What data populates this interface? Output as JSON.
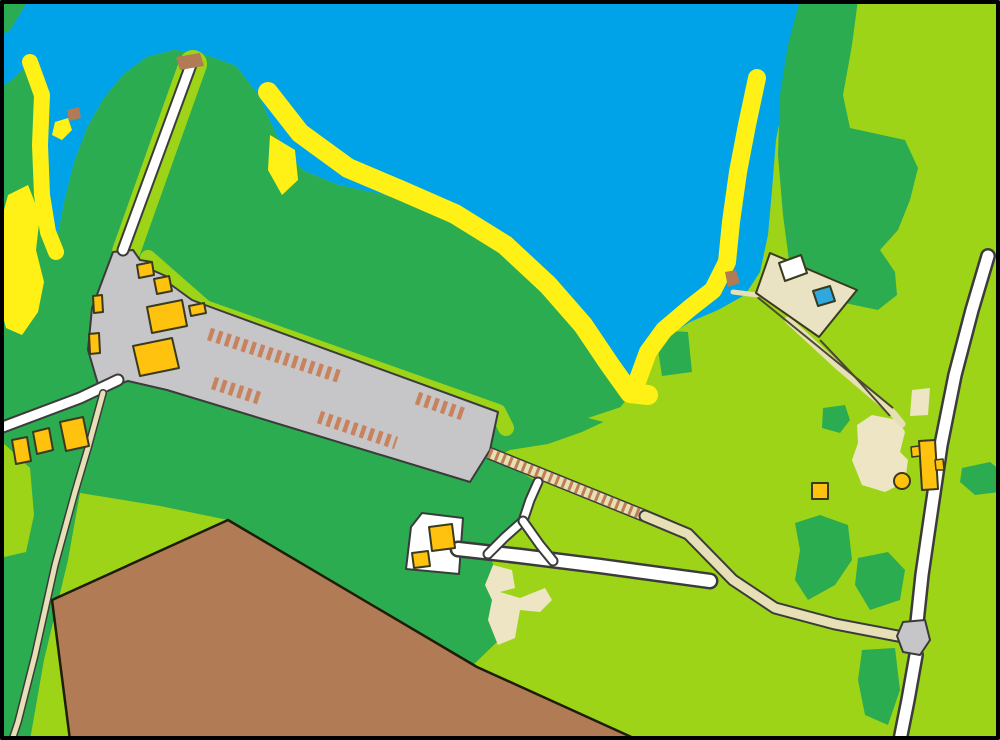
{
  "canvas": {
    "width": 1000,
    "height": 740
  },
  "palette": {
    "water": "#00A2E8",
    "forest": "#2CAC50",
    "open": "#9ED417",
    "beach": "#FFF115",
    "field": "#B07B55",
    "field_border": "#1F1C07",
    "paved": "#C6C5C7",
    "casing": "#3B3B3B",
    "road_white": "#FFFFFF",
    "path_beige": "#E7E0B6",
    "rung": "#BE7F52",
    "sand": "#EDE5C3",
    "compound": "#E9E2C3",
    "building": "#FFC20E",
    "building_outline": "#3A3A1E",
    "car": "#C9825E",
    "pool": "#2FA8E0",
    "pier": "#B07B55",
    "fence": "#4A4A32",
    "frame": "#000000"
  },
  "map": {
    "features": [
      {
        "name": "lake-water",
        "kind": "polygon",
        "fill": "water",
        "pts": "28,0 822,0 800,50 785,95 776,140 772,190 768,235 760,272 745,295 718,310 690,322 662,340 645,358 634,390 618,368 590,330 558,293 520,258 478,228 432,208 385,195 338,185 302,170 278,138 258,95 236,66 206,55 174,50 147,57 124,74 104,98 87,128 74,163 64,203 57,240 50,250 43,238 39,195 39,145 42,105 37,75 25,68 12,80 0,88 0,36 10,30"
      },
      {
        "name": "forest-top-left-corner",
        "kind": "polygon",
        "fill": "forest",
        "pts": "0,0 28,0 10,30 0,36"
      },
      {
        "name": "forest-main-west",
        "kind": "polygon",
        "fill": "forest",
        "pts": "0,88 12,80 25,68 37,75 42,105 39,145 39,195 43,238 50,250 57,240 64,203 74,163 87,128 104,98 124,74 147,57 174,50 206,55 236,66 258,95 278,138 302,170 338,185 385,195 432,208 478,228 520,258 558,293 590,330 618,368 634,390 626,400 612,418 582,432 548,444 510,450 494,458 538,482 526,520 490,556 497,575 499,640 468,670 373,604 228,520 160,506 80,493 68,560 44,660 30,740 0,740"
      },
      {
        "name": "forest-northeast-band",
        "kind": "polygon",
        "fill": "forest",
        "pts": "800,0 858,0 852,45 843,95 850,128 905,140 918,168 910,200 898,230 880,250 895,272 897,295 878,310 840,302 810,288 790,268 783,215 778,155 780,95 788,45"
      },
      {
        "name": "bush-east-1",
        "kind": "polygon",
        "fill": "forest",
        "pts": "823,408 845,405 850,420 840,433 822,428"
      },
      {
        "name": "bush-east-2",
        "kind": "polygon",
        "fill": "forest",
        "pts": "795,523 820,515 848,525 852,560 835,585 808,600 795,580 800,550"
      },
      {
        "name": "bush-east-3",
        "kind": "polygon",
        "fill": "forest",
        "pts": "858,558 888,552 905,570 900,600 870,610 855,585"
      },
      {
        "name": "bush-east-4",
        "kind": "polygon",
        "fill": "forest",
        "pts": "862,650 895,648 900,690 888,725 865,715 858,680"
      },
      {
        "name": "bush-east-5",
        "kind": "polygon",
        "fill": "forest",
        "pts": "962,468 990,462 1000,470 1000,492 975,495 960,482"
      },
      {
        "name": "bush-bay-notch",
        "kind": "polygon",
        "fill": "forest",
        "pts": "655,330 688,332 692,372 662,376"
      },
      {
        "name": "road-verge-pier",
        "kind": "stroke",
        "stroke": "open",
        "w": 28,
        "pts": "193,64 158,162 126,252"
      },
      {
        "name": "clearing-left-edge",
        "kind": "polygon",
        "fill": "open",
        "pts": "0,440 30,468 34,515 26,552 0,558"
      },
      {
        "name": "clearing-triangle",
        "kind": "polygon",
        "fill": "open",
        "pts": "80,493 215,521 108,580"
      },
      {
        "name": "verge-parking-edge",
        "kind": "stroke",
        "stroke": "open",
        "w": 16,
        "pts": "148,258 205,308 498,412 506,428"
      },
      {
        "name": "clearing-bay-south",
        "kind": "polygon",
        "fill": "open",
        "pts": "588,418 648,398 715,420 655,435"
      },
      {
        "name": "beach-west",
        "kind": "stroke",
        "stroke": "beach",
        "w": 20,
        "pts": "268,92 300,133 348,168 400,190 455,214 505,245 548,285 583,325 610,365 630,393 648,395"
      },
      {
        "name": "beach-east",
        "kind": "stroke",
        "stroke": "beach",
        "w": 18,
        "pts": "757,78 747,125 738,172 731,222 727,262 713,290 690,308 664,330 648,352 637,382"
      },
      {
        "name": "beach-inlet",
        "kind": "stroke",
        "stroke": "beach",
        "w": 16,
        "pts": "30,62 42,95 40,145 42,195 48,232 56,252"
      },
      {
        "name": "beach-left-blob",
        "kind": "polygon",
        "fill": "beach",
        "pts": "8,195 28,185 40,215 36,250 44,282 38,312 22,335 6,328 0,305 0,225"
      },
      {
        "name": "beach-hook",
        "kind": "polygon",
        "fill": "beach",
        "pts": "55,122 68,118 72,130 62,140 52,135"
      },
      {
        "name": "beach-headland-patch",
        "kind": "polygon",
        "fill": "beach",
        "pts": "270,135 295,150 298,180 282,195 268,170"
      },
      {
        "name": "plowed-field",
        "kind": "polygon",
        "fill": "field",
        "stroke": "field_border",
        "sw": 2.5,
        "pts": "70,740 52,600 228,520 477,667 638,740"
      },
      {
        "name": "sand-patch-south",
        "kind": "polygon",
        "fill": "sand",
        "pts": "493,565 512,570 515,588 500,592 520,598 545,588 552,600 540,612 520,610 515,638 498,645 488,620 492,600 485,585"
      },
      {
        "name": "sand-patch-east",
        "kind": "polygon",
        "fill": "sand",
        "pts": "857,425 872,415 898,420 905,432 900,452 908,460 905,482 885,492 862,485 852,460 858,443"
      },
      {
        "name": "sand-patch-east-small",
        "kind": "polygon",
        "fill": "sand",
        "pts": "912,390 930,388 928,415 910,416"
      },
      {
        "name": "parking-lot",
        "kind": "polygon",
        "fill": "paved",
        "stroke": "casing",
        "sw": 2,
        "pts": "113,252 133,250 140,260 152,262 152,270 168,277 170,284 192,300 205,305 498,412 490,450 470,482 167,390 128,381 100,391 88,350 92,308"
      },
      {
        "name": "stairs-path-casing",
        "kind": "stroke",
        "stroke": "casing",
        "w": 13,
        "cap": "butt",
        "pts": "489,453 645,516"
      },
      {
        "name": "stairs-path-bed",
        "kind": "stroke",
        "stroke": "path_beige",
        "w": 10,
        "cap": "butt",
        "pts": "489,453 645,516"
      },
      {
        "name": "stairs-path-rungs",
        "kind": "stroke",
        "stroke": "rung",
        "w": 10,
        "cap": "butt",
        "dash": "3,4.2",
        "pts": "489,453 645,516"
      },
      {
        "name": "road-pier",
        "kind": "road",
        "pts": "192,62 123,250",
        "casing_w": 13,
        "fill_w": 9
      },
      {
        "name": "road-west-curve",
        "kind": "road",
        "pts": "0,428 40,413 80,398 118,380",
        "casing_w": 13,
        "fill_w": 9
      },
      {
        "name": "path-southwest",
        "kind": "road",
        "pts": "103,393 88,448 75,492 55,565 35,655 18,722 12,740",
        "casing_w": 8,
        "fill_w": 5,
        "fill": "path_beige"
      },
      {
        "name": "yard-pad",
        "kind": "polygon",
        "fill": "road_white",
        "stroke": "casing",
        "sw": 2,
        "pts": "422,513 463,518 459,574 406,569 411,527"
      },
      {
        "name": "road-south-main",
        "kind": "road",
        "pts": "458,549 520,556 600,566 710,581",
        "casing_w": 17,
        "fill_w": 12
      },
      {
        "name": "path-branch-west",
        "kind": "road",
        "pts": "488,554 505,537 523,521",
        "casing_w": 11,
        "fill_w": 7
      },
      {
        "name": "path-branch-north",
        "kind": "road",
        "pts": "523,521 530,500 538,482",
        "casing_w": 11,
        "fill_w": 7
      },
      {
        "name": "path-branch-east",
        "kind": "road",
        "pts": "523,521 540,545 553,561",
        "casing_w": 11,
        "fill_w": 7
      },
      {
        "name": "path-main-beige",
        "kind": "road",
        "pts": "645,516 688,534 733,580 775,608 835,624 903,637",
        "casing_w": 13,
        "fill_w": 9,
        "fill": "path_beige"
      },
      {
        "name": "road-east-upper",
        "kind": "road",
        "pts": "988,256 972,310 955,375 941,445 930,520 922,575 917,622",
        "casing_w": 16,
        "fill_w": 11
      },
      {
        "name": "road-east-lower",
        "kind": "road",
        "pts": "916,655 908,700 900,740",
        "casing_w": 16,
        "fill_w": 11
      },
      {
        "name": "junction-pad",
        "kind": "polygon",
        "fill": "paved",
        "stroke": "casing",
        "sw": 2,
        "pts": "903,622 925,620 930,640 920,655 903,652 897,636"
      },
      {
        "name": "path-compound-lane",
        "kind": "stroke",
        "stroke": "path_beige",
        "w": 7,
        "pts": "788,320 840,368 893,413 902,424"
      },
      {
        "name": "fence-lane-upper",
        "kind": "stroke",
        "stroke": "fence",
        "w": 2,
        "cap": "butt",
        "pts": "756,296 820,348 893,408"
      },
      {
        "name": "fence-lane-lower",
        "kind": "stroke",
        "stroke": "fence",
        "w": 2,
        "cap": "butt",
        "pts": "820,340 856,378 890,416"
      },
      {
        "name": "path-compound-shore",
        "kind": "stroke",
        "stroke": "path_beige",
        "w": 5,
        "pts": "733,292 757,295"
      },
      {
        "name": "compound-yard",
        "kind": "polygon",
        "fill": "compound",
        "stroke": "building_outline",
        "sw": 2,
        "pts": "770,253 857,290 819,337 756,293"
      },
      {
        "name": "building-white-house",
        "kind": "polygon",
        "fill": "road_white",
        "stroke": "building_outline",
        "sw": 2,
        "pts": "779,263 801,255 807,273 785,281"
      },
      {
        "name": "swimming-pool",
        "kind": "polygon",
        "fill": "pool",
        "stroke": "building_outline",
        "sw": 2,
        "pts": "813,291 830,286 835,301 818,306"
      },
      {
        "name": "building-a",
        "kind": "polygon",
        "fill": "building",
        "stroke": "building_outline",
        "sw": 2,
        "pts": "137,265 152,262 154,275 139,278"
      },
      {
        "name": "building-b",
        "kind": "polygon",
        "fill": "building",
        "stroke": "building_outline",
        "sw": 2,
        "pts": "154,279 169,276 172,291 157,294"
      },
      {
        "name": "building-c",
        "kind": "polygon",
        "fill": "building",
        "stroke": "building_outline",
        "sw": 2,
        "pts": "93,296 102,295 103,312 94,313"
      },
      {
        "name": "building-d-large",
        "kind": "polygon",
        "fill": "building",
        "stroke": "building_outline",
        "sw": 2,
        "pts": "147,307 182,300 187,326 152,333"
      },
      {
        "name": "building-e",
        "kind": "polygon",
        "fill": "building",
        "stroke": "building_outline",
        "sw": 2,
        "pts": "189,306 204,303 206,313 191,316"
      },
      {
        "name": "building-f",
        "kind": "polygon",
        "fill": "building",
        "stroke": "building_outline",
        "sw": 2,
        "pts": "89,334 99,333 100,353 90,354"
      },
      {
        "name": "building-g-large",
        "kind": "polygon",
        "fill": "building",
        "stroke": "building_outline",
        "sw": 2,
        "pts": "133,346 172,338 179,368 140,376"
      },
      {
        "name": "building-h",
        "kind": "polygon",
        "fill": "building",
        "stroke": "building_outline",
        "sw": 2,
        "pts": "12,440 27,437 31,461 16,464"
      },
      {
        "name": "building-i",
        "kind": "polygon",
        "fill": "building",
        "stroke": "building_outline",
        "sw": 2,
        "pts": "33,432 49,428 53,450 37,454"
      },
      {
        "name": "building-j",
        "kind": "polygon",
        "fill": "building",
        "stroke": "building_outline",
        "sw": 2,
        "pts": "60,422 83,417 89,446 66,451"
      },
      {
        "name": "building-k",
        "kind": "polygon",
        "fill": "building",
        "stroke": "building_outline",
        "sw": 2,
        "pts": "429,527 452,524 455,548 432,551"
      },
      {
        "name": "building-l",
        "kind": "polygon",
        "fill": "building",
        "stroke": "building_outline",
        "sw": 2,
        "pts": "412,553 428,551 430,566 414,568"
      },
      {
        "name": "building-m",
        "kind": "polygon",
        "fill": "building",
        "stroke": "building_outline",
        "sw": 2,
        "pts": "812,483 828,483 828,499 812,499"
      },
      {
        "name": "building-n-main",
        "kind": "polygon",
        "fill": "building",
        "stroke": "building_outline",
        "sw": 2,
        "pts": "919,441 935,440 938,489 922,490"
      },
      {
        "name": "building-n-wing-west",
        "kind": "polygon",
        "fill": "building",
        "stroke": "building_outline",
        "sw": 1.5,
        "pts": "911,447 919,446 920,456 912,457"
      },
      {
        "name": "building-n-wing-east",
        "kind": "polygon",
        "fill": "building",
        "stroke": "building_outline",
        "sw": 1.5,
        "pts": "935,460 943,459 944,470 936,470"
      },
      {
        "name": "tank-circle",
        "kind": "circle",
        "cx": 902,
        "cy": 481,
        "r": 8,
        "fill": "building",
        "stroke": "building_outline",
        "sw": 2
      },
      {
        "name": "parked-row-1",
        "kind": "stroke",
        "stroke": "car",
        "w": 13,
        "cap": "butt",
        "dash": "4.4,4.4",
        "pts": "209,334 341,377"
      },
      {
        "name": "parked-row-2",
        "kind": "stroke",
        "stroke": "car",
        "w": 13,
        "cap": "butt",
        "dash": "4.4,4.4",
        "pts": "213,383 262,399"
      },
      {
        "name": "parked-row-3",
        "kind": "stroke",
        "stroke": "car",
        "w": 13,
        "cap": "butt",
        "dash": "4.4,4.4",
        "pts": "319,417 396,443"
      },
      {
        "name": "parked-row-4",
        "kind": "stroke",
        "stroke": "car",
        "w": 13,
        "cap": "butt",
        "dash": "4.4,4.4",
        "pts": "417,398 463,414"
      },
      {
        "name": "pier-head",
        "kind": "polygon",
        "fill": "pier",
        "pts": "176,57 200,53 204,66 180,70"
      },
      {
        "name": "boat-landing",
        "kind": "polygon",
        "fill": "pier",
        "pts": "725,272 736,270 740,283 728,287"
      },
      {
        "name": "boat",
        "kind": "polygon",
        "fill": "pier",
        "pts": "67,110 79,107 81,118 69,121"
      },
      {
        "name": "map-frame",
        "kind": "polygon",
        "fill": "none",
        "stroke": "frame",
        "sw": 4,
        "pts": "2,2 998,2 998,738 2,738"
      }
    ]
  }
}
